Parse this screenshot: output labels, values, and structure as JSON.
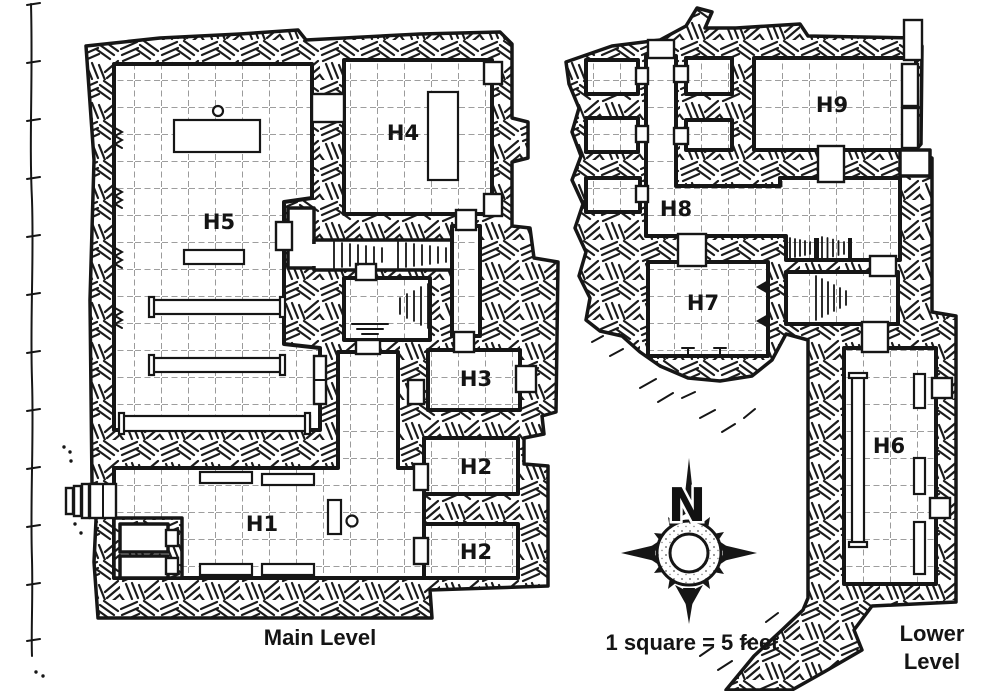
{
  "page": {
    "paper_color": "#ffffff",
    "ink_color": "#161616",
    "grid_color": "#909090"
  },
  "map": {
    "captions": {
      "main_level": "Main Level",
      "scale": "1 square = 5 feet",
      "lower_level_line1": "Lower",
      "lower_level_line2": "Level"
    },
    "compass": {
      "north_label": "N"
    },
    "room_labels": {
      "h1": "H1",
      "h2": "H2",
      "h3": "H3",
      "h4": "H4",
      "h5": "H5",
      "h6": "H6",
      "h7": "H7",
      "h8": "H8",
      "h9": "H9"
    }
  }
}
